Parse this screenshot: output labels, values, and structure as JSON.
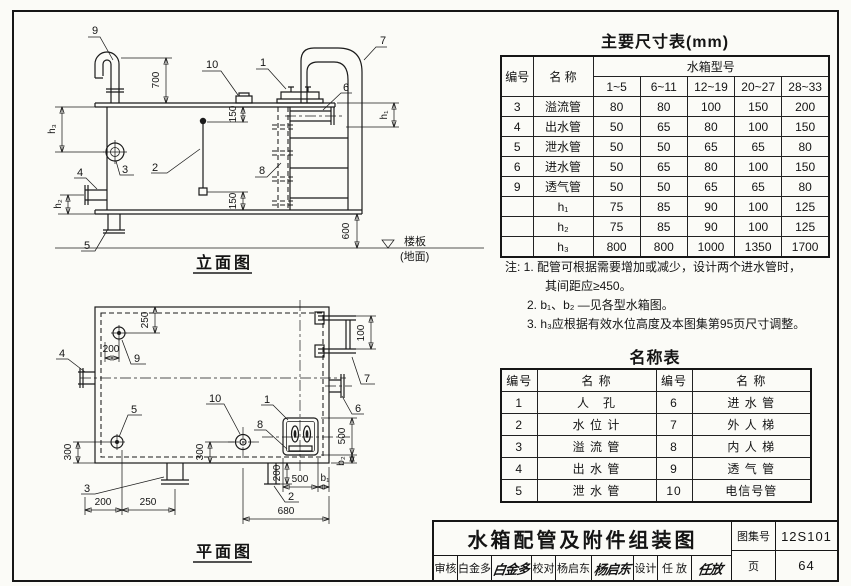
{
  "parts": {
    "p1": "1",
    "p2": "2",
    "p3": "3",
    "p4": "4",
    "p5": "5",
    "p6": "6",
    "p7": "7",
    "p8": "8",
    "p9": "9",
    "p10": "10"
  },
  "elevation": {
    "label": "立面图",
    "floor_label": "楼板",
    "ground_label": "(地面)",
    "dims": {
      "d700": "700",
      "d150_top": "150",
      "d150_bottom": "150",
      "d600": "600",
      "h1": "h₁",
      "h2": "h₂",
      "h3": "h₃"
    }
  },
  "plan": {
    "label": "平面图",
    "dims": {
      "d250": "250",
      "d200_vent": "200",
      "d100": "100",
      "d300_drain": "300",
      "d300_signal": "300",
      "d200_gauge": "200",
      "d200_bottom": "200",
      "d250_bottom": "250",
      "d500_width": "500",
      "b1": "b₁",
      "d680": "680",
      "d500_height": "500",
      "b2": "b₂"
    }
  },
  "dim_table": {
    "title": "主要尺寸表(mm)",
    "header": {
      "no": "编号",
      "name": "名 称",
      "group": "水箱型号"
    },
    "models": [
      "1~5",
      "6~11",
      "12~19",
      "20~27",
      "28~33"
    ],
    "rows": [
      {
        "no": "3",
        "name": "溢流管",
        "v": [
          "80",
          "80",
          "100",
          "150",
          "200"
        ]
      },
      {
        "no": "4",
        "name": "出水管",
        "v": [
          "50",
          "65",
          "80",
          "100",
          "150"
        ]
      },
      {
        "no": "5",
        "name": "泄水管",
        "v": [
          "50",
          "50",
          "65",
          "65",
          "80"
        ]
      },
      {
        "no": "6",
        "name": "进水管",
        "v": [
          "50",
          "65",
          "80",
          "100",
          "150"
        ]
      },
      {
        "no": "9",
        "name": "透气管",
        "v": [
          "50",
          "50",
          "65",
          "65",
          "80"
        ]
      },
      {
        "no": "",
        "name": "h₁",
        "v": [
          "75",
          "85",
          "90",
          "100",
          "125"
        ]
      },
      {
        "no": "",
        "name": "h₂",
        "v": [
          "75",
          "85",
          "90",
          "100",
          "125"
        ]
      },
      {
        "no": "",
        "name": "h₃",
        "v": [
          "800",
          "800",
          "1000",
          "1350",
          "1700"
        ]
      }
    ]
  },
  "notes": {
    "lines": [
      {
        "text": "注: 1. 配管可根据需要增加或减少，设计两个进水管时，"
      },
      {
        "text": "其间距应≥450。"
      },
      {
        "text": "2. b₁、b₂ —见各型水箱图。"
      },
      {
        "text": "3. h₃应根据有效水位高度及本图集第95页尺寸调整。"
      }
    ]
  },
  "name_table": {
    "title": "名称表",
    "headers": [
      "编号",
      "名 称",
      "编号",
      "名 称"
    ],
    "rows": [
      [
        "1",
        "人　孔",
        "6",
        "进 水 管"
      ],
      [
        "2",
        "水 位 计",
        "7",
        "外 人 梯"
      ],
      [
        "3",
        "溢 流 管",
        "8",
        "内 人 梯"
      ],
      [
        "4",
        "出 水 管",
        "9",
        "透 气 管"
      ],
      [
        "5",
        "泄 水 管",
        "10",
        "电信号管"
      ]
    ]
  },
  "title_block": {
    "title": "水箱配管及附件组装图",
    "atlas_label": "图集号",
    "atlas_no": "12S101",
    "page_label": "页",
    "page_no": "64",
    "review_label": "审核",
    "review_name": "白金多",
    "review_sig": "白金多",
    "check_label": "校对",
    "check_name": "杨启东",
    "check_sig": "杨启东",
    "design_label": "设计",
    "design_name": "任 放",
    "design_sig": "任放"
  }
}
